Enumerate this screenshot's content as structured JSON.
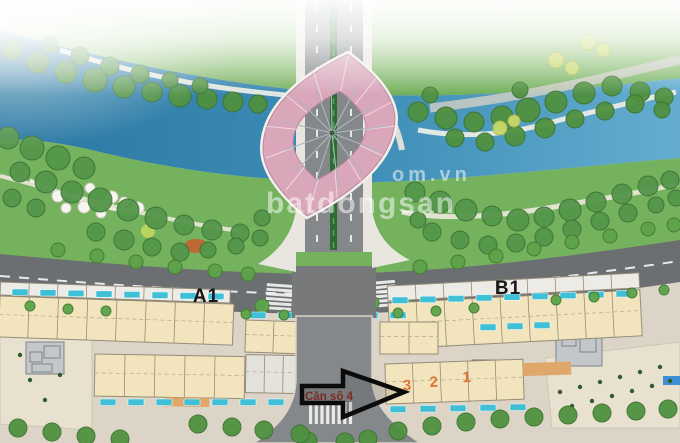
{
  "scene": {
    "type": "aerial-masterplan-rendering",
    "description": "Bird's-eye site plan of a riverside development: river crossed by a bridge with a pink leaf-shaped observation structure, green park banks, boulevard with shop-house rows"
  },
  "watermark": {
    "line1": "om.vn",
    "line2": "batdongsan"
  },
  "road_labels": {
    "left": "A1",
    "right": "B1"
  },
  "arrow": {
    "label": "Căn số 4"
  },
  "unit_numbers": [
    "3",
    "2",
    "1"
  ],
  "colors": {
    "river_deep": "#2a78a2",
    "river_light": "#64adcf",
    "bank_green": "#74b25e",
    "road_gray": "#6c6f71",
    "bridge_pink": "#d9a6ba",
    "building_cream": "#f2e4bc",
    "tag_teal": "#3fc0d6",
    "number_orange": "#e0702a",
    "arrow_black": "#0b0b0b"
  }
}
